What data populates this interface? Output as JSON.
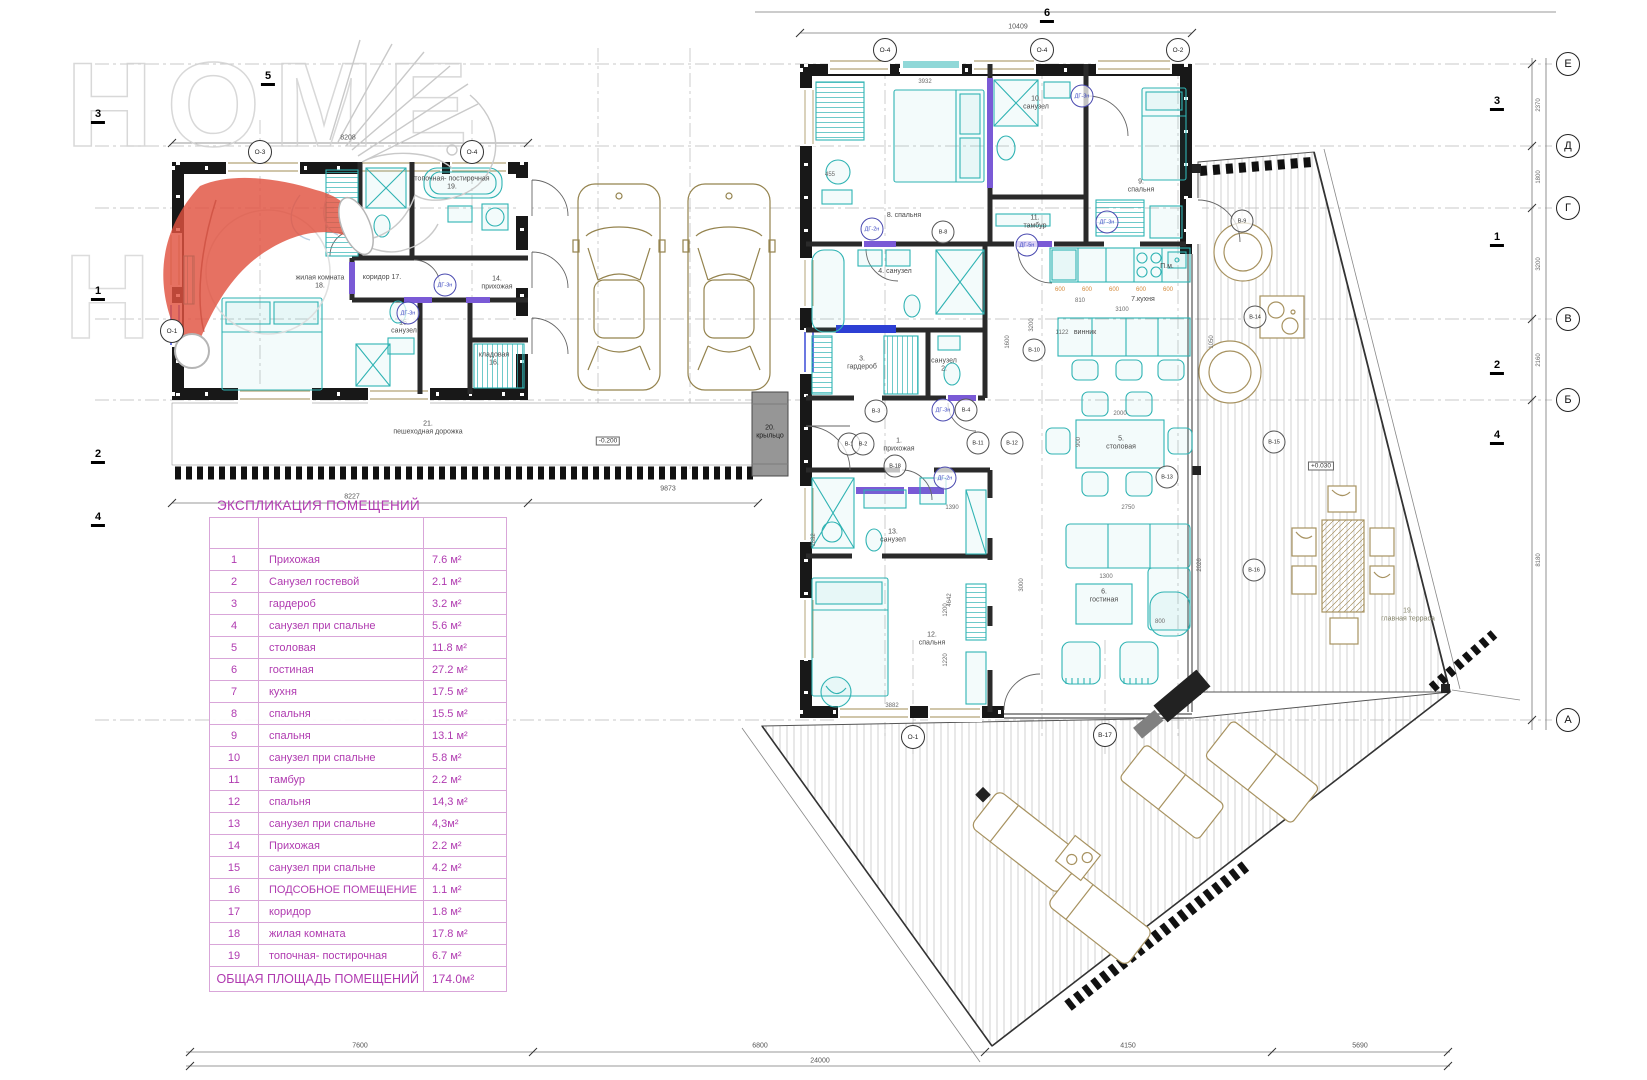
{
  "watermark": {
    "line1": "HOME",
    "line2": "H"
  },
  "legend": {
    "title": "ЭКСПЛИКАЦИЯ ПОМЕЩЕНИЙ",
    "rows": [
      {
        "num": "1",
        "name": "Прихожая",
        "area": "7.6 м²"
      },
      {
        "num": "2",
        "name": "Санузел гостевой",
        "area": "2.1 м²"
      },
      {
        "num": "3",
        "name": "гардероб",
        "area": "3.2 м²"
      },
      {
        "num": "4",
        "name": "санузел при спальне",
        "area": "5.6 м²"
      },
      {
        "num": "5",
        "name": "столовая",
        "area": "11.8 м²"
      },
      {
        "num": "6",
        "name": "гостиная",
        "area": "27.2 м²"
      },
      {
        "num": "7",
        "name": "кухня",
        "area": "17.5 м²"
      },
      {
        "num": "8",
        "name": "спальня",
        "area": "15.5 м²"
      },
      {
        "num": "9",
        "name": "спальня",
        "area": "13.1 м²"
      },
      {
        "num": "10",
        "name": "санузел при спальне",
        "area": "5.8 м²"
      },
      {
        "num": "11",
        "name": "тамбур",
        "area": "2.2 м²"
      },
      {
        "num": "12",
        "name": "спальня",
        "area": "14,3 м²"
      },
      {
        "num": "13",
        "name": "санузел при спальне",
        "area": "4,3м²"
      },
      {
        "num": "14",
        "name": "Прихожая",
        "area": "2.2 м²"
      },
      {
        "num": "15",
        "name": "санузел при спальне",
        "area": "4.2 м²"
      },
      {
        "num": "16",
        "name": "ПОДСОБНОЕ ПОМЕЩЕНИЕ",
        "area": "1.1 м²"
      },
      {
        "num": "17",
        "name": "коридор",
        "area": "1.8 м²"
      },
      {
        "num": "18",
        "name": "жилая комната",
        "area": "17.8 м²"
      },
      {
        "num": "19",
        "name": "топочная- постирочная",
        "area": "6.7 м²"
      }
    ],
    "total_label": "ОБЩАЯ ПЛОЩАДЬ ПОМЕЩЕНИЙ",
    "total_value": "174.0м²"
  },
  "labels": {
    "room18": "жилая комната\n18.",
    "room17": "коридор 17.",
    "room15": "15.\nсанузел",
    "room14": "14.\nприхожая",
    "room16": "кладовая\n16.",
    "room19": "топочная- постирочная\n19.",
    "room8": "8. спальня",
    "room10": "10.\nсанузел",
    "room11": "11.\nтамбур",
    "room9": "9.\nспальня",
    "room4": "4. санузел",
    "room3": "3.\nгардероб",
    "room2": "санузел\n2.",
    "room1": "1.\nприхожая",
    "room7": "7.кухня",
    "pm": "П.м.",
    "vinnik": "винник",
    "room5": "5.\nстоловая",
    "room6": "6.\nгостиная",
    "room12": "12.\nспальня",
    "room13": "13.\nсанузел",
    "room20": "20.\nкрыльцо",
    "room21": "21.\nпешеходная дорожка",
    "terrace": "19.\nглавная терраса"
  },
  "elevations": {
    "terrace": "+0.030",
    "walkway": "-0.200"
  },
  "axis_letters": {
    "e": "Е",
    "d": "Д",
    "g": "Г",
    "v": "В",
    "b": "Б",
    "a": "А"
  },
  "axis_circles": {
    "c1": "О-3",
    "c2": "О-4",
    "c3": "О-4",
    "c4": "О-4",
    "c5": "О-2",
    "c6": "О-1",
    "c7": "В-17",
    "c8": "О-1"
  },
  "sections": {
    "s5": "5",
    "s6": "6",
    "l3": "3",
    "l1": "1",
    "l2": "2",
    "l4": "4",
    "r3": "3",
    "r1": "1",
    "r2": "2",
    "r4": "4"
  },
  "markers": {
    "m1": "ДГ-2н",
    "m2": "В-8",
    "m3": "ДГ-5н",
    "m4": "ДГ-3н",
    "m5": "ДГ-3н",
    "m6": "В-3",
    "m7": "ДГ-3н",
    "m8": "В-4",
    "m9": "В-1",
    "m10": "В-2",
    "m11": "В-11",
    "m12": "В-12",
    "m13": "В-18",
    "m14": "ДГ-2н",
    "m15": "В-13",
    "m16": "В-10",
    "m17": "В-9",
    "m18": "В-14",
    "m19": "В-15",
    "m20": "В-16",
    "m21": "ДГ-3н",
    "m22": "ДГ-3н"
  },
  "dims": {
    "top": "10409",
    "lbtop": "8208",
    "walk1": "8227",
    "walk2": "9873",
    "b1": "7600",
    "b2": "6800",
    "b3": "4150",
    "b4": "5690",
    "btotal": "24000",
    "r1": "2370",
    "r2": "1800",
    "r3": "3200",
    "r4": "2160",
    "r5": "8180",
    "k1": "600",
    "k2": "600",
    "k3": "600",
    "k4": "600",
    "k5": "600",
    "k6": "810",
    "d1": "3932",
    "d2": "2750",
    "d3": "3000",
    "d4": "900",
    "d5": "2000",
    "d6": "3100",
    "d7": "1122",
    "d8": "3200",
    "d9": "1600",
    "d10": "4642",
    "d11": "1832",
    "d12": "3882",
    "d13": "1220",
    "d14": "1200",
    "d15": "1300",
    "d16": "800",
    "d17": "2026",
    "d18": "1050",
    "d19": "1390",
    "d20": "455"
  },
  "colors": {
    "teal": "#2fb3b3",
    "purple": "#7a5ad6",
    "blue": "#2d3fd4",
    "legend_text": "#b03ab0",
    "legend_border": "#d9a6d9",
    "hat_red": "#e0523f",
    "tan": "#94834e",
    "wall": "#181818"
  }
}
